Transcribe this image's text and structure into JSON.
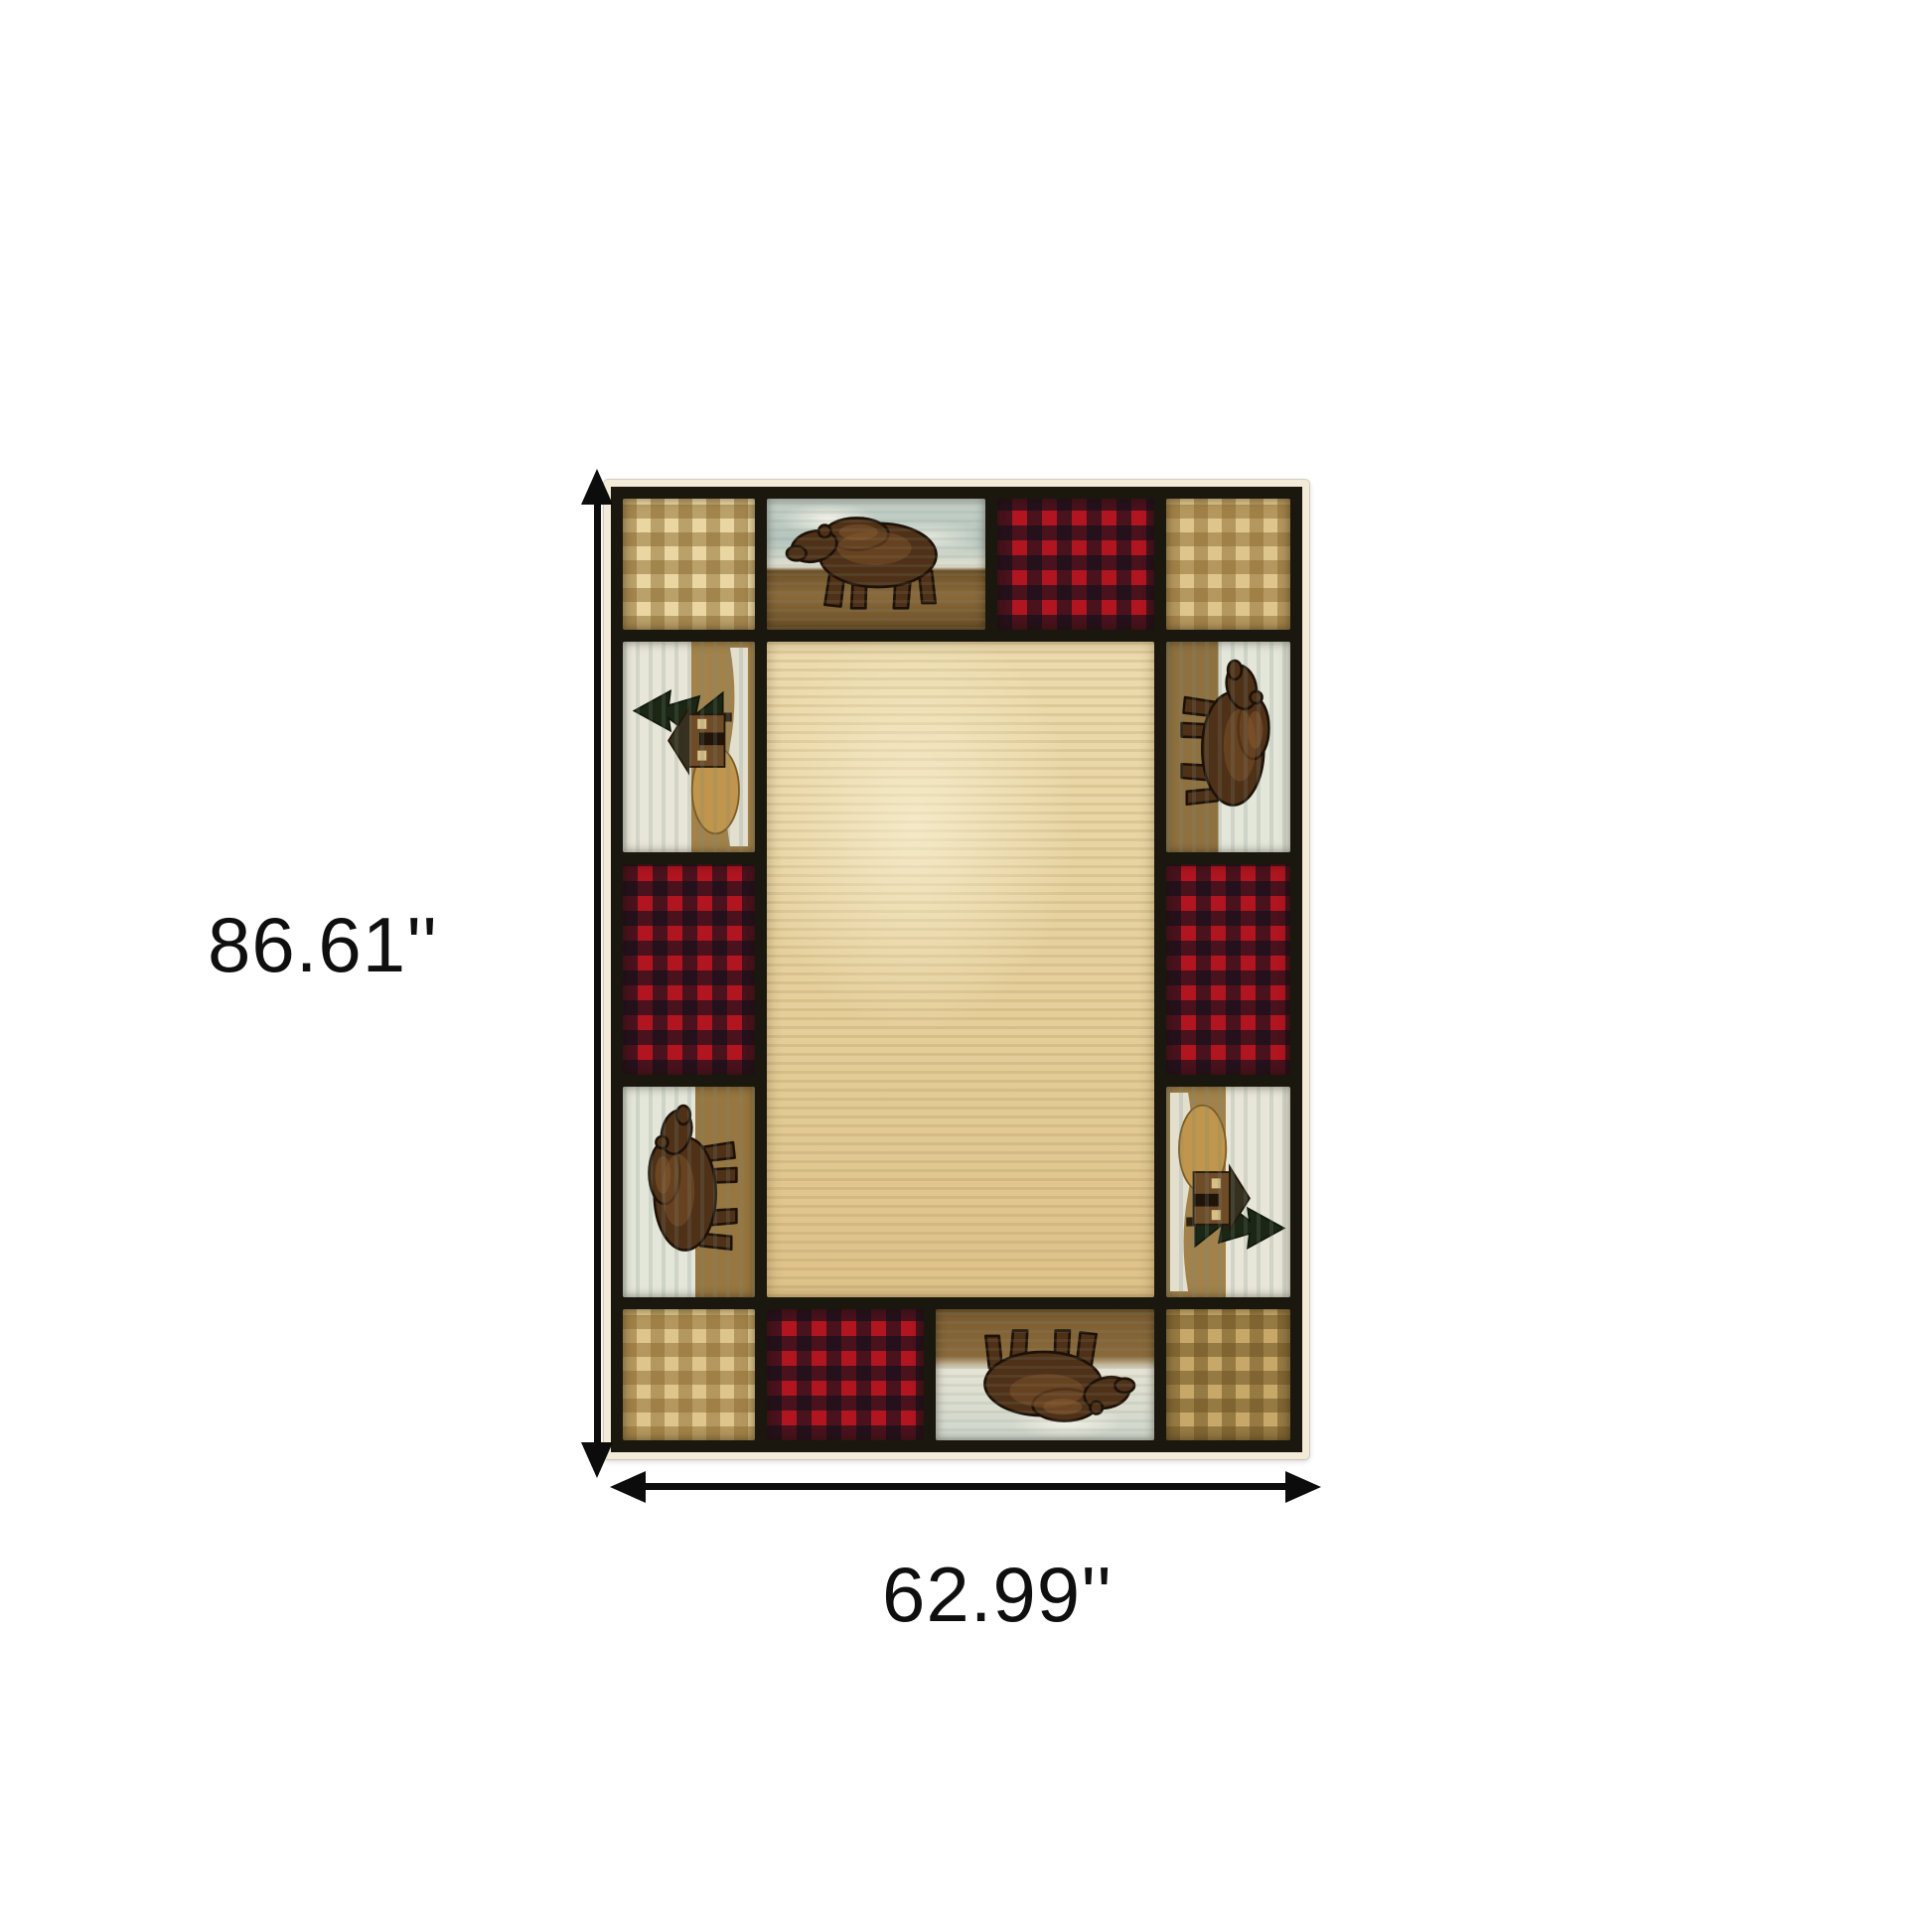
{
  "image_type": "product dimension diagram of an area rug",
  "background_color": "#ffffff",
  "dimensions": {
    "height_label": "86.61''",
    "width_label": "62.99''"
  },
  "annotations": {
    "vertical_arrow": "double-headed-vertical-arrow",
    "horizontal_arrow": "double-headed-horizontal-arrow",
    "arrow_color": "#0c0c0c",
    "label_color": "#0f0f0f"
  },
  "rug": {
    "style": "rustic lodge patchwork border rug with bears, cabins, buffalo plaid and gingham checks around a plain cream field",
    "center_field_color": "#e6d3a0",
    "grid_line_color": "#1a170f",
    "fringe_color": "#f3ebd8",
    "palette": {
      "gingham_tan": "#e9d6a2",
      "gingham_stripe": "#8b6a30",
      "plaid_red": "#b01520",
      "plaid_dark": "#12101a",
      "bear_brown": "#4f3118",
      "bear_highlight": "#7c5128",
      "sky_gray_blue": "#b5c5bd",
      "ground_brown": "#7a5c30",
      "snow_white": "#e7e5d6",
      "cabin_brown": "#6e4c28",
      "tree_green": "#1c2615",
      "hay_gold": "#c0954c"
    },
    "border_motifs": {
      "top_row": [
        "gingham-check",
        "walking-bear",
        "buffalo-plaid",
        "gingham-check"
      ],
      "left_column": [
        "cabin-scene",
        "buffalo-plaid",
        "climbing-bear"
      ],
      "right_column": [
        "climbing-bear",
        "buffalo-plaid",
        "cabin-scene"
      ],
      "bottom_row": [
        "gingham-check",
        "buffalo-plaid",
        "inverted-walking-bear",
        "gingham-check"
      ]
    }
  }
}
